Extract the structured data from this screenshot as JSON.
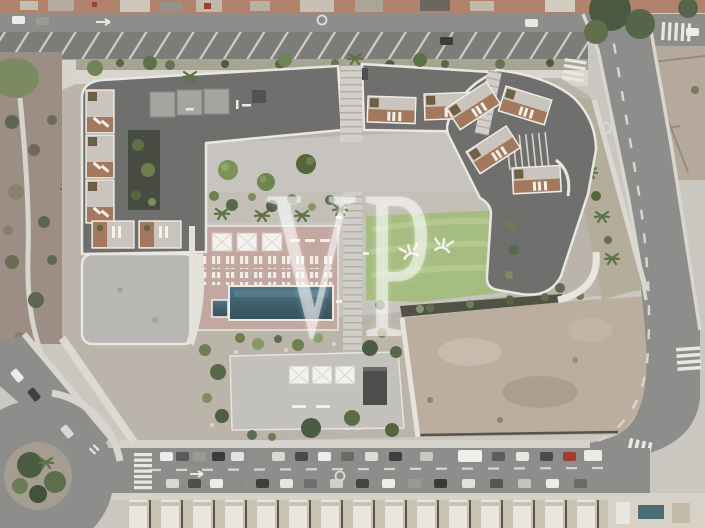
{
  "scene": {
    "type": "aerial-site-plan-rendering",
    "description": "Top-down architectural rendering of a U-shaped residential complex with rooftop terraces, central courtyard, pool deck, lawn, surrounding streets, parking, roundabout and vacant lots",
    "watermark": "VP"
  },
  "colors": {
    "roofDark": "#6f6f6d",
    "roofLight": "#b9b7b3",
    "plaza": "#c7c4bf",
    "poolDeck": "#c2a8a0",
    "pool": "#40606c",
    "lawn": "#a6bd82",
    "deckWood": "#a3785c",
    "road": "#8d8d8b",
    "parking": "#7c7c78",
    "sidewalk": "#d8d5cf",
    "scrub": "#9c8e85",
    "dirt": "#bbae9e",
    "terracotta": "#b2836c",
    "marking": "#e9e7e2",
    "hedge": "#4f5244"
  }
}
